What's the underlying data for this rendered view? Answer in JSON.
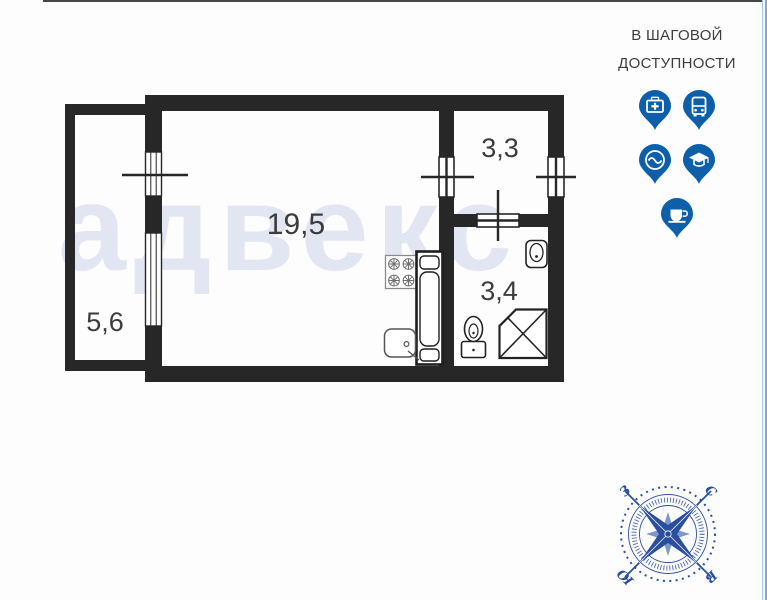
{
  "header": {
    "title": "В ШАГОВОЙ ДОСТУПНОСТИ"
  },
  "nearby_icons": [
    {
      "label": "medical"
    },
    {
      "label": "transport"
    },
    {
      "label": "water"
    },
    {
      "label": "education"
    },
    {
      "label": "cafe"
    }
  ],
  "floor_plan": {
    "watermark": "адвекс",
    "rooms": [
      {
        "name": "balcony",
        "area": "5,6"
      },
      {
        "name": "living-room",
        "area": "19,5"
      },
      {
        "name": "hallway",
        "area": "3,3"
      },
      {
        "name": "bathroom",
        "area": "3,4"
      }
    ]
  },
  "compass": {
    "north": "С",
    "east": "В",
    "south": "Ю",
    "west": "З"
  },
  "colors": {
    "wall": "#272727",
    "accent_blue": "#0e5fa9",
    "compass_blue": "#2b4f9e",
    "watermark": "#e2e6f3"
  }
}
